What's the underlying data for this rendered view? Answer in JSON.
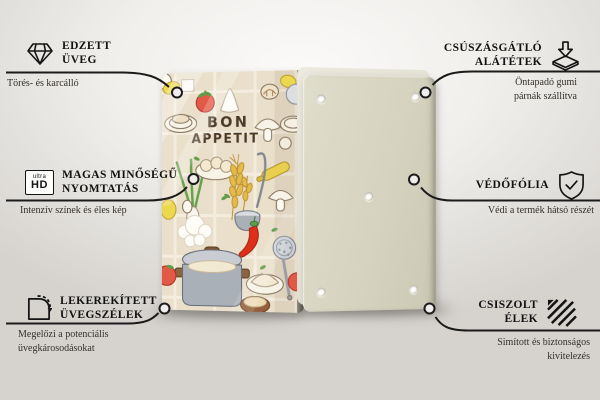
{
  "page": {
    "background_top": "#fbfaf9",
    "background_bottom": "#d6d3cf",
    "line_color": "#1b1b1b"
  },
  "callouts": {
    "left": [
      {
        "icon": "diamond-icon",
        "title_lines": [
          "EDZETT",
          "ÜVEG"
        ],
        "subtitle_lines": [
          "Törés- és karcálló"
        ]
      },
      {
        "icon": "ultra-hd-icon",
        "badge_small": "ultra",
        "badge_big": "HD",
        "title_lines": [
          "MAGAS MINŐSÉGŰ",
          "NYOMTATÁS"
        ],
        "subtitle_lines": [
          "Intenzív színek és éles kép"
        ]
      },
      {
        "icon": "rounded-corner-icon",
        "title_lines": [
          "LEKEREKÍTETT",
          "ÜVEGSZÉLEK"
        ],
        "subtitle_lines": [
          "Megelőzi a potenciális",
          "üvegkárosodásokat"
        ]
      }
    ],
    "right": [
      {
        "icon": "anti-slip-pads-icon",
        "title_lines": [
          "CSÚSZÁSGÁTLÓ",
          "ALÁTÉTEK"
        ],
        "subtitle_lines": [
          "Öntapadó gumi",
          "párnák szállítva"
        ]
      },
      {
        "icon": "shield-check-icon",
        "title_lines": [
          "VÉDŐFÓLIA"
        ],
        "subtitle_lines": [
          "Védi a termék hátsó részét"
        ]
      },
      {
        "icon": "polished-edges-icon",
        "title_lines": [
          "CSISZOLT",
          "ÉLEK"
        ],
        "subtitle_lines": [
          "Simított és biztonságos",
          "kivitelezés"
        ]
      }
    ]
  },
  "product": {
    "front_text_line1": "BON",
    "front_text_line2": "APPETIT",
    "colors": {
      "front_board_bg": "#eadfcb",
      "back_board": "#d6d4c0",
      "tomato": "#e25948",
      "chili": "#de2f1a",
      "pot": "#aab0b8",
      "wheat": "#e5ba4b"
    }
  }
}
